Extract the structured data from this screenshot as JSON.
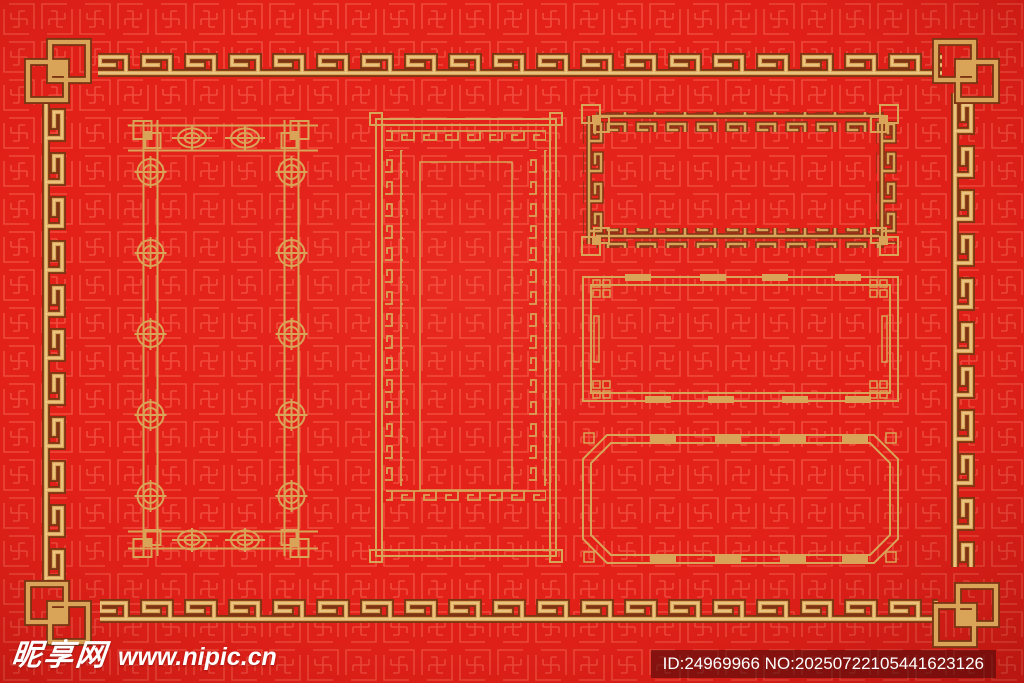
{
  "watermark": {
    "site_name": "昵享网",
    "site_url": "www.nipic.cn",
    "id_text": "ID:24969966 NO:20250722105441623126"
  },
  "colors": {
    "bg-red": "#e32119",
    "bg-red-dark": "#bf1016",
    "pattern-red": "#ff7a64",
    "gold": "#d9a457",
    "gold-light": "#f3d394",
    "gold-dark": "#7d3413",
    "bar-bg": "rgba(66,8,10,0.55)",
    "text-white": "#ffffff"
  }
}
